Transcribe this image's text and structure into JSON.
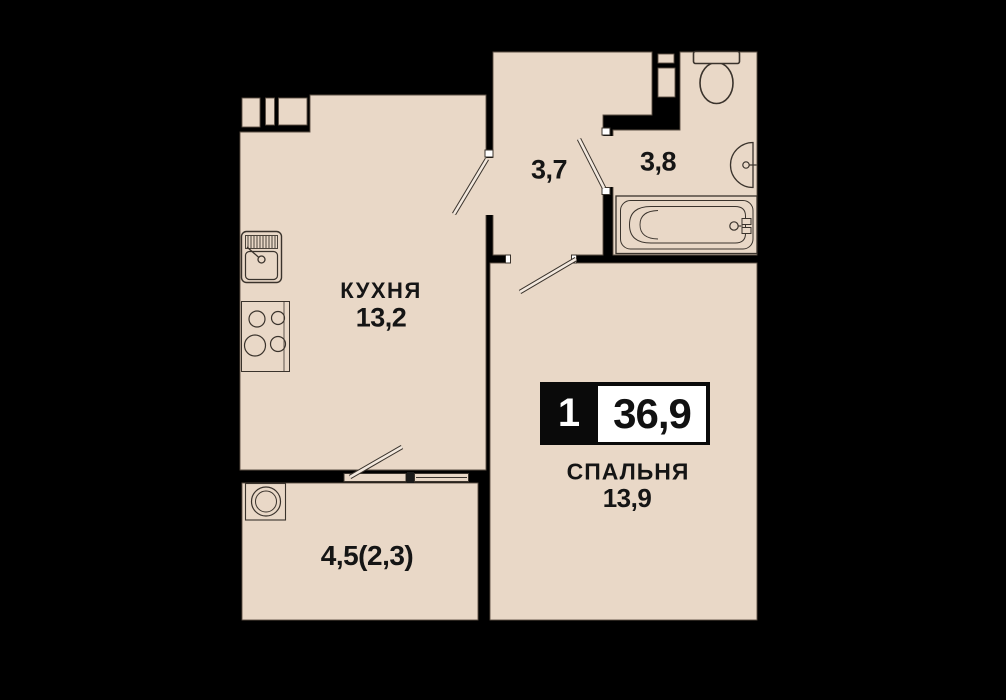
{
  "unit_badge": {
    "rooms_count": "1",
    "total_area": "36,9"
  },
  "rooms": {
    "kitchen": {
      "name": "КУХНЯ",
      "area": "13,2"
    },
    "bedroom": {
      "name": "СПАЛЬНЯ",
      "area": "13,9"
    },
    "hallway": {
      "area": "3,7"
    },
    "bathroom": {
      "area": "3,8"
    },
    "balcony": {
      "area": "4,5(2,3)"
    }
  },
  "colors": {
    "background": "#000000",
    "floor": "#e9d8c7",
    "room_outline": "#5c5044",
    "fixture_line": "#3a332c",
    "text": "#151515",
    "badge_background": "#0a0a0a",
    "badge_panel": "#ffffff"
  },
  "icons": [
    "kitchen-sink-icon",
    "stove-icon",
    "washing-machine-icon",
    "toilet-icon",
    "washbasin-icon",
    "bathtub-icon",
    "door-swing-icon",
    "window-icon",
    "vent-shaft-icon"
  ]
}
